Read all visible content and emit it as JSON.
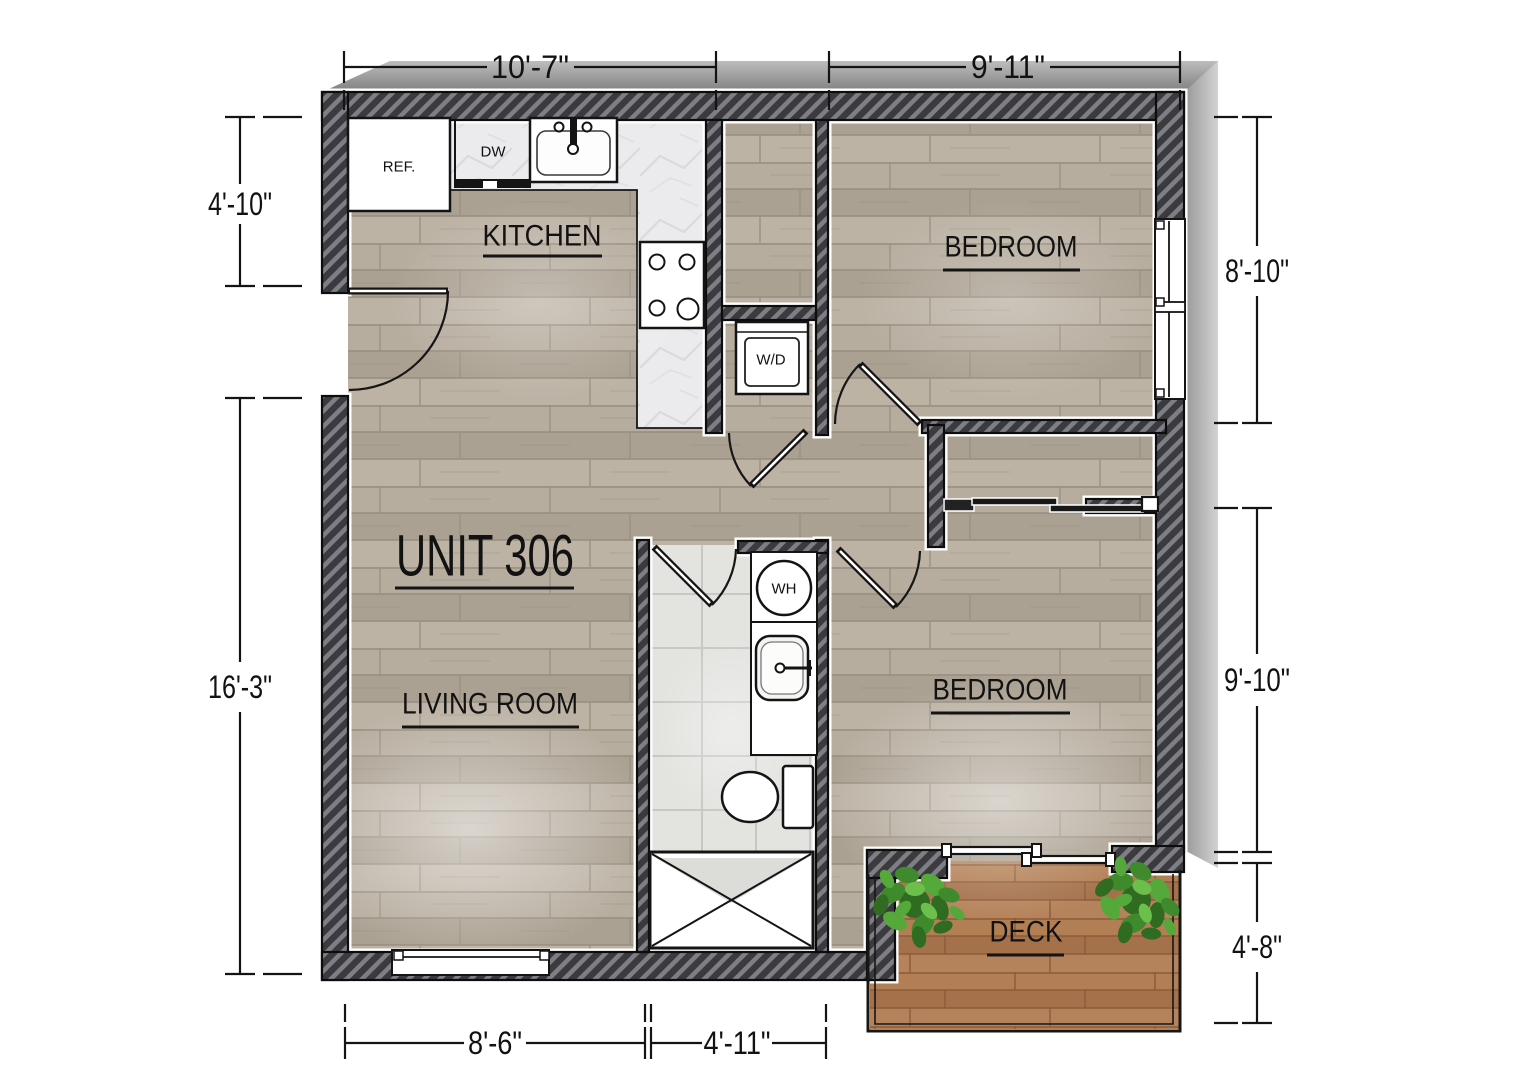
{
  "plan": {
    "unit_label": "UNIT 306",
    "rooms": {
      "kitchen": "KITCHEN",
      "bedroom_top": "BEDROOM",
      "bedroom_right": "BEDROOM",
      "living_room": "LIVING ROOM",
      "deck": "DECK"
    },
    "fixtures": {
      "refrigerator": "REF.",
      "dishwasher": "DW",
      "washer_dryer": "W/D",
      "water_heater": "WH"
    },
    "dimensions": {
      "top": [
        "10'-7\"",
        "9'-11\""
      ],
      "left": [
        "4'-10\"",
        "16'-3\""
      ],
      "right": [
        "8'-10\"",
        "9'-10\"",
        "4'-8\""
      ],
      "bottom": [
        "8'-6\"",
        "4'-11\""
      ]
    },
    "colors": {
      "wall_dark": "#3b3b3f",
      "wall_hatch_stripe": "#7e7e85",
      "wood_floor": "#b4aa9c",
      "deck_wood": "#ad7a50",
      "bath_tile": "#e3e3e0",
      "counter_marble": "#ebebed",
      "plant_green": "#3f8a2c",
      "line_ink": "#141414"
    }
  }
}
